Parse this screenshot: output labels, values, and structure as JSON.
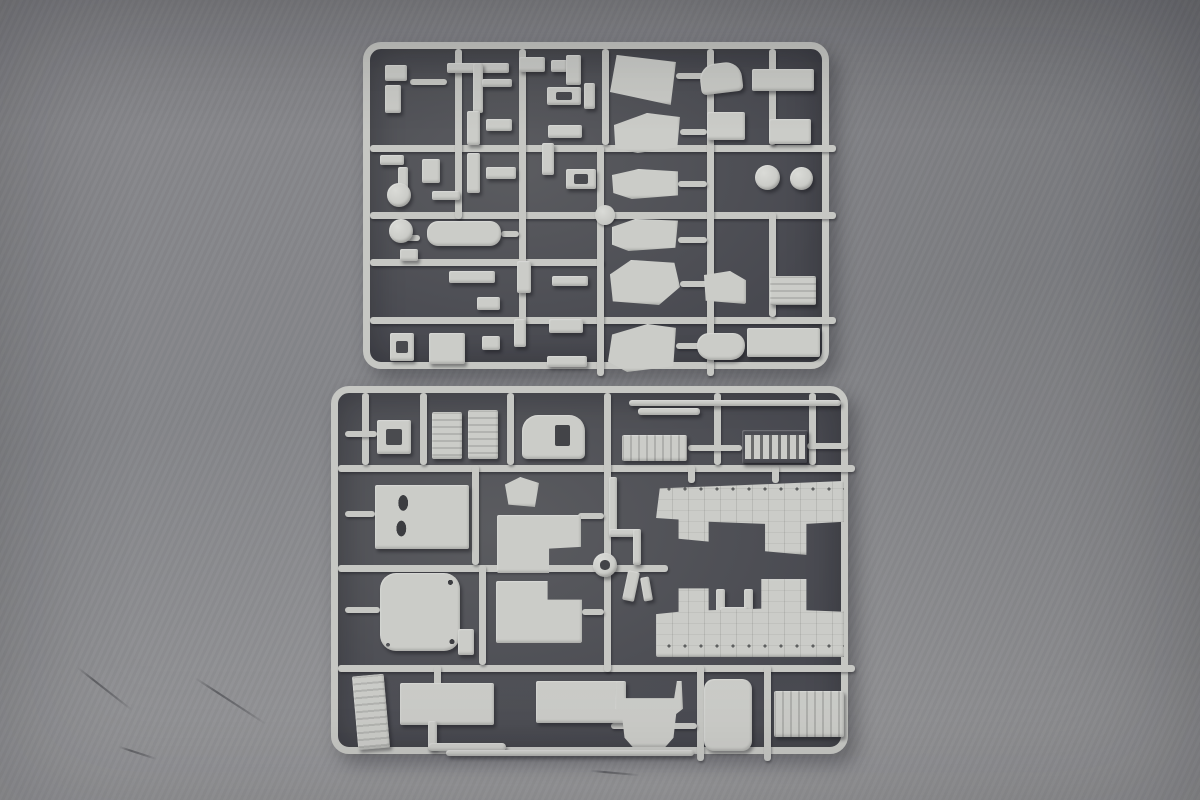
{
  "scene": {
    "colors": {
      "bg-top": "#88888c",
      "bg-mid": "#85868a",
      "bg-bottom": "#9c9c9e",
      "bed-light": "#5b5c60",
      "bed-dark": "#484950",
      "plastic": "#c6c7c3",
      "plastic-hi": "#dadbd7",
      "plastic-part": "#cbccc8"
    }
  },
  "sprues": [
    {
      "name": "sprue-frame-top",
      "x": 363,
      "y": 42,
      "w": 466,
      "h": 327,
      "runners": [
        {
          "x": 0,
          "y": 96,
          "w": 466,
          "h": 7
        },
        {
          "x": 0,
          "y": 163,
          "w": 466,
          "h": 7
        },
        {
          "x": 0,
          "y": 210,
          "w": 234,
          "h": 7
        },
        {
          "x": 0,
          "y": 268,
          "w": 466,
          "h": 7
        },
        {
          "x": 85,
          "y": 0,
          "w": 7,
          "h": 170
        },
        {
          "x": 149,
          "y": 0,
          "w": 7,
          "h": 275
        },
        {
          "x": 227,
          "y": 96,
          "w": 7,
          "h": 231
        },
        {
          "x": 232,
          "y": 0,
          "w": 7,
          "h": 96
        },
        {
          "x": 337,
          "y": 0,
          "w": 7,
          "h": 327
        },
        {
          "x": 399,
          "y": 0,
          "w": 7,
          "h": 96
        },
        {
          "x": 399,
          "y": 163,
          "w": 7,
          "h": 105
        },
        {
          "x": 40,
          "y": 30,
          "w": 37,
          "h": 6
        },
        {
          "x": 306,
          "y": 24,
          "w": 31,
          "h": 6
        },
        {
          "x": 310,
          "y": 80,
          "w": 27,
          "h": 6
        },
        {
          "x": 308,
          "y": 132,
          "w": 29,
          "h": 6
        },
        {
          "x": 308,
          "y": 188,
          "w": 29,
          "h": 6
        },
        {
          "x": 310,
          "y": 232,
          "w": 27,
          "h": 6
        },
        {
          "x": 306,
          "y": 294,
          "w": 31,
          "h": 6
        },
        {
          "x": 36,
          "y": 186,
          "w": 14,
          "h": 6
        },
        {
          "x": 131,
          "y": 182,
          "w": 18,
          "h": 6
        },
        {
          "x": 225,
          "y": 156,
          "w": 20,
          "h": 20,
          "knob": true
        }
      ],
      "parts": [
        {
          "name": "angle-clip-a",
          "x": 15,
          "y": 16,
          "w": 22,
          "h": 16
        },
        {
          "name": "angle-clip-b",
          "x": 15,
          "y": 36,
          "w": 16,
          "h": 28
        },
        {
          "name": "axle-t-bar",
          "x": 77,
          "y": 14,
          "w": 62,
          "h": 10
        },
        {
          "name": "axle-stem",
          "x": 103,
          "y": 14,
          "w": 10,
          "h": 50
        },
        {
          "name": "cross-bar",
          "x": 112,
          "y": 30,
          "w": 30,
          "h": 8
        },
        {
          "name": "bracket-top",
          "x": 149,
          "y": 8,
          "w": 26,
          "h": 15
        },
        {
          "name": "clip-tiny",
          "x": 181,
          "y": 11,
          "w": 16,
          "h": 12
        },
        {
          "name": "l-bracket",
          "x": 196,
          "y": 6,
          "w": 15,
          "h": 30
        },
        {
          "name": "bench-stand",
          "x": 177,
          "y": 38,
          "w": 34,
          "h": 18,
          "detail": "hole-center"
        },
        {
          "name": "figure-post",
          "x": 214,
          "y": 34,
          "w": 11,
          "h": 26
        },
        {
          "name": "hull-glacis-panel-1",
          "x": 240,
          "y": 6,
          "w": 66,
          "h": 50,
          "clip": "polygon(10% 0, 100% 14%, 92% 100%, 0 74%)"
        },
        {
          "name": "curved-roof-panel",
          "x": 330,
          "y": 14,
          "w": 42,
          "h": 30,
          "r": "16px 16px 5px 5px",
          "rot": -7
        },
        {
          "name": "top-plate",
          "x": 382,
          "y": 20,
          "w": 62,
          "h": 22
        },
        {
          "name": "tiny-t-part-a",
          "x": 10,
          "y": 106,
          "w": 24,
          "h": 10
        },
        {
          "name": "tiny-t-part-b",
          "x": 28,
          "y": 118,
          "w": 10,
          "h": 28
        },
        {
          "name": "tiny-angle-part",
          "x": 52,
          "y": 110,
          "w": 18,
          "h": 24
        },
        {
          "name": "tiny-bar-part",
          "x": 62,
          "y": 142,
          "w": 28,
          "h": 9
        },
        {
          "name": "channel-rail-a",
          "x": 97,
          "y": 62,
          "w": 13,
          "h": 34
        },
        {
          "name": "channel-rail-b",
          "x": 97,
          "y": 104,
          "w": 13,
          "h": 40
        },
        {
          "name": "step-bar-a",
          "x": 116,
          "y": 70,
          "w": 26,
          "h": 12
        },
        {
          "name": "step-bar-b",
          "x": 116,
          "y": 118,
          "w": 30,
          "h": 12
        },
        {
          "name": "bench-frame",
          "x": 178,
          "y": 76,
          "w": 34,
          "h": 13
        },
        {
          "name": "post-pair",
          "x": 172,
          "y": 94,
          "w": 12,
          "h": 32
        },
        {
          "name": "h-table-bracket",
          "x": 196,
          "y": 120,
          "w": 30,
          "h": 20,
          "detail": "hole-center"
        },
        {
          "name": "hull-glacis-panel-2",
          "x": 244,
          "y": 64,
          "w": 66,
          "h": 40,
          "clip": "polygon(0 30%, 50% 0, 100% 10%, 96% 86%, 36% 100%, 2% 88%)"
        },
        {
          "name": "box-part-a",
          "x": 337,
          "y": 63,
          "w": 38,
          "h": 28
        },
        {
          "name": "box-part-b",
          "x": 399,
          "y": 70,
          "w": 42,
          "h": 25
        },
        {
          "name": "wheel-dome-a",
          "shape": "circle",
          "x": 385,
          "y": 116,
          "w": 25,
          "h": 25
        },
        {
          "name": "wheel-dome-b",
          "shape": "circle",
          "x": 420,
          "y": 118,
          "w": 23,
          "h": 23
        },
        {
          "name": "road-wheel-a",
          "shape": "circle",
          "x": 17,
          "y": 134,
          "w": 24,
          "h": 24
        },
        {
          "name": "road-wheel-b",
          "shape": "circle",
          "x": 19,
          "y": 170,
          "w": 24,
          "h": 24
        },
        {
          "name": "hull-tub-part",
          "x": 57,
          "y": 172,
          "w": 74,
          "h": 25,
          "r": 11
        },
        {
          "name": "mini-mount",
          "x": 30,
          "y": 200,
          "w": 18,
          "h": 12
        },
        {
          "name": "hook-rod",
          "x": 147,
          "y": 212,
          "w": 14,
          "h": 32
        },
        {
          "name": "knob-bar",
          "x": 79,
          "y": 222,
          "w": 46,
          "h": 12
        },
        {
          "name": "elbow-clip",
          "x": 107,
          "y": 248,
          "w": 23,
          "h": 13
        },
        {
          "name": "rod-flat",
          "x": 182,
          "y": 227,
          "w": 36,
          "h": 10
        },
        {
          "name": "hull-step-panel-3",
          "x": 242,
          "y": 120,
          "w": 66,
          "h": 30,
          "clip": "polygon(0 20%, 40% 0, 100% 8%, 100% 88%, 30% 100%, 2% 80%)"
        },
        {
          "name": "hull-step-panel-4",
          "x": 242,
          "y": 170,
          "w": 66,
          "h": 32,
          "clip": "polygon(0 25%, 35% 0, 100% 5%, 96% 90%, 25% 100%, 0 80%)"
        },
        {
          "name": "hull-glacis-panel-5",
          "x": 240,
          "y": 211,
          "w": 70,
          "h": 45,
          "clip": "polygon(0 32%, 30% 0, 92% 6%, 100% 60%, 70% 100%, 4% 92%)"
        },
        {
          "name": "hull-glacis-panel-6",
          "x": 238,
          "y": 275,
          "w": 68,
          "h": 48,
          "clip": "polygon(6% 22%, 58% 0, 100% 8%, 96% 88%, 28% 100%, 0 78%)"
        },
        {
          "name": "angled-block",
          "x": 334,
          "y": 222,
          "w": 42,
          "h": 33,
          "clip": "polygon(0 12%, 62% 0, 100% 28%, 100% 100%, 4% 90%)"
        },
        {
          "name": "ribbed-plate",
          "x": 400,
          "y": 227,
          "w": 46,
          "h": 29,
          "detail": "stripes-h"
        },
        {
          "name": "corner-bracket",
          "x": 20,
          "y": 284,
          "w": 24,
          "h": 28,
          "detail": "hole-center"
        },
        {
          "name": "notched-block",
          "x": 59,
          "y": 284,
          "w": 36,
          "h": 31
        },
        {
          "name": "clip-small",
          "x": 112,
          "y": 287,
          "w": 18,
          "h": 14
        },
        {
          "name": "pin-part-a",
          "x": 144,
          "y": 270,
          "w": 12,
          "h": 28
        },
        {
          "name": "pin-part-b",
          "x": 179,
          "y": 270,
          "w": 34,
          "h": 14
        },
        {
          "name": "rail-bar",
          "x": 177,
          "y": 307,
          "w": 40,
          "h": 11
        },
        {
          "name": "tub-round-part",
          "x": 327,
          "y": 284,
          "w": 48,
          "h": 27,
          "r": "12px 12px 14px 14px"
        },
        {
          "name": "plate-long",
          "x": 377,
          "y": 279,
          "w": 73,
          "h": 29
        }
      ]
    },
    {
      "name": "sprue-frame-bottom",
      "x": 331,
      "y": 386,
      "w": 517,
      "h": 368,
      "runners": [
        {
          "x": 0,
          "y": 72,
          "w": 517,
          "h": 7
        },
        {
          "x": 0,
          "y": 172,
          "w": 330,
          "h": 7
        },
        {
          "x": 0,
          "y": 272,
          "w": 517,
          "h": 7
        },
        {
          "x": 24,
          "y": 0,
          "w": 7,
          "h": 72
        },
        {
          "x": 82,
          "y": 0,
          "w": 7,
          "h": 72
        },
        {
          "x": 169,
          "y": 0,
          "w": 7,
          "h": 72
        },
        {
          "x": 266,
          "y": 0,
          "w": 7,
          "h": 279
        },
        {
          "x": 376,
          "y": 0,
          "w": 7,
          "h": 72
        },
        {
          "x": 471,
          "y": 0,
          "w": 7,
          "h": 72
        },
        {
          "x": 134,
          "y": 72,
          "w": 7,
          "h": 100
        },
        {
          "x": 141,
          "y": 172,
          "w": 7,
          "h": 100
        },
        {
          "x": 359,
          "y": 272,
          "w": 7,
          "h": 96
        },
        {
          "x": 426,
          "y": 272,
          "w": 7,
          "h": 96
        },
        {
          "x": 7,
          "y": 38,
          "w": 32,
          "h": 6
        },
        {
          "x": 210,
          "y": 42,
          "w": 20,
          "h": 6
        },
        {
          "x": 350,
          "y": 52,
          "w": 54,
          "h": 6
        },
        {
          "x": 469,
          "y": 50,
          "w": 41,
          "h": 6
        },
        {
          "x": 7,
          "y": 118,
          "w": 30,
          "h": 6
        },
        {
          "x": 7,
          "y": 214,
          "w": 35,
          "h": 6
        },
        {
          "x": 240,
          "y": 120,
          "w": 26,
          "h": 6
        },
        {
          "x": 244,
          "y": 216,
          "w": 22,
          "h": 6
        },
        {
          "x": 350,
          "y": 72,
          "w": 7,
          "h": 18
        },
        {
          "x": 434,
          "y": 72,
          "w": 7,
          "h": 18
        },
        {
          "x": 273,
          "y": 330,
          "w": 86,
          "h": 6
        },
        {
          "x": 96,
          "y": 272,
          "w": 7,
          "h": 24
        }
      ],
      "parts": [
        {
          "name": "ring-frame-part",
          "x": 39,
          "y": 27,
          "w": 34,
          "h": 34,
          "detail": "hole-center"
        },
        {
          "name": "striped-panel-a",
          "x": 94,
          "y": 19,
          "w": 30,
          "h": 47,
          "detail": "stripes-h"
        },
        {
          "name": "striped-panel-b",
          "x": 130,
          "y": 17,
          "w": 30,
          "h": 49,
          "detail": "stripes-h"
        },
        {
          "name": "arch-hatch-panel",
          "x": 184,
          "y": 22,
          "w": 63,
          "h": 44,
          "r": "16px 16px 5px 5px",
          "detail": "hole-square"
        },
        {
          "name": "barrel-rod",
          "x": 291,
          "y": 7,
          "w": 212,
          "h": 6,
          "r": 3
        },
        {
          "name": "rod-fitting",
          "x": 300,
          "y": 15,
          "w": 62,
          "h": 7,
          "r": 3
        },
        {
          "name": "radiator-panel-small",
          "x": 284,
          "y": 42,
          "w": 65,
          "h": 26,
          "detail": "stripes-v"
        },
        {
          "name": "track-grille-part",
          "x": 404,
          "y": 37,
          "w": 66,
          "h": 34,
          "detail": "grille"
        },
        {
          "name": "panel-with-two-holes",
          "x": 37,
          "y": 92,
          "w": 94,
          "h": 64,
          "detail": "holes2"
        },
        {
          "name": "winch-block",
          "x": 167,
          "y": 84,
          "w": 34,
          "h": 30,
          "clip": "polygon(0 25%, 45% 0, 100% 20%, 88% 100%, 10% 92%)"
        },
        {
          "name": "step-panel-a",
          "x": 159,
          "y": 122,
          "w": 84,
          "h": 58,
          "clip": "polygon(0 0, 100% 0, 100% 55%, 62% 58%, 62% 100%, 0 100%)"
        },
        {
          "name": "pipe-s-vertical",
          "x": 271,
          "y": 84,
          "w": 8,
          "h": 58
        },
        {
          "name": "pipe-s-horizontal",
          "x": 271,
          "y": 136,
          "w": 30,
          "h": 8
        },
        {
          "name": "pipe-s-vertical-2",
          "x": 295,
          "y": 136,
          "w": 8,
          "h": 36
        },
        {
          "name": "hull-side-upper",
          "x": 318,
          "y": 88,
          "w": 188,
          "h": 74,
          "detail": "rivets-top",
          "clip": "polygon(0 50%, 2% 10%, 100% 0, 100% 55%, 80% 58%, 80% 100%, 58% 95%, 58% 58%, 28% 55%, 28% 82%, 12% 78%, 12% 52%)"
        },
        {
          "name": "hatch-round-panel",
          "x": 42,
          "y": 180,
          "w": 80,
          "h": 78,
          "r": 16,
          "detail": "dots-corners"
        },
        {
          "name": "step-panel-b",
          "x": 158,
          "y": 188,
          "w": 86,
          "h": 62,
          "clip": "polygon(0 0, 60% 0, 60% 30%, 100% 30%, 100% 100%, 0 100%)"
        },
        {
          "name": "hook-clip",
          "x": 120,
          "y": 236,
          "w": 16,
          "h": 26
        },
        {
          "name": "sprue-gate-hub",
          "shape": "circle",
          "x": 255,
          "y": 160,
          "w": 24,
          "h": 24,
          "detail": "hole-center-round"
        },
        {
          "name": "clip-part-a",
          "x": 287,
          "y": 178,
          "w": 12,
          "h": 30,
          "rot": 12
        },
        {
          "name": "clip-part-b",
          "x": 304,
          "y": 184,
          "w": 9,
          "h": 24,
          "rot": -10
        },
        {
          "name": "h-bracket-left",
          "x": 378,
          "y": 196,
          "w": 9,
          "h": 46
        },
        {
          "name": "h-bracket-right",
          "x": 406,
          "y": 196,
          "w": 9,
          "h": 46
        },
        {
          "name": "h-bracket-bar",
          "x": 382,
          "y": 214,
          "w": 28,
          "h": 9
        },
        {
          "name": "hull-side-lower",
          "x": 318,
          "y": 186,
          "w": 188,
          "h": 78,
          "detail": "rivets-bottom",
          "clip": "polygon(0 45%, 12% 42%, 12% 12%, 28% 12%, 28% 40%, 56% 38%, 56% 0, 80% 0, 80% 40%, 100% 42%, 100% 100%, 0 100%)"
        },
        {
          "name": "side-skirt-panel",
          "x": 17,
          "y": 282,
          "w": 32,
          "h": 74,
          "rot": -5,
          "detail": "stripes-h"
        },
        {
          "name": "floor-panel-a",
          "x": 62,
          "y": 290,
          "w": 94,
          "h": 42
        },
        {
          "name": "pipe-elbow-vertical",
          "x": 90,
          "y": 328,
          "w": 9,
          "h": 28
        },
        {
          "name": "pipe-elbow-horizontal",
          "x": 90,
          "y": 350,
          "w": 78,
          "h": 8,
          "r": 4
        },
        {
          "name": "floor-panel-b",
          "x": 198,
          "y": 288,
          "w": 90,
          "h": 42
        },
        {
          "name": "long-rod",
          "x": 108,
          "y": 357,
          "w": 248,
          "h": 6,
          "r": 3
        },
        {
          "name": "bumper-trough",
          "x": 277,
          "y": 288,
          "w": 68,
          "h": 66,
          "clip": "polygon(2% 0, 9% 0, 13% 26%, 87% 26%, 91% 0, 98% 0, 100% 42%, 90% 50%, 86% 86%, 74% 100%, 26% 100%, 14% 86%, 10% 50%, 0 42%)"
        },
        {
          "name": "door-panel",
          "x": 366,
          "y": 286,
          "w": 48,
          "h": 72,
          "r": 10
        },
        {
          "name": "radiator-panel-large",
          "x": 436,
          "y": 298,
          "w": 70,
          "h": 46,
          "detail": "stripes-v"
        }
      ]
    }
  ],
  "scratches": [
    {
      "x": 70,
      "y": 688,
      "w": 70,
      "rot": 38
    },
    {
      "x": 188,
      "y": 700,
      "w": 85,
      "rot": 33
    },
    {
      "x": 118,
      "y": 752,
      "w": 40,
      "rot": 18
    },
    {
      "x": 590,
      "y": 772,
      "w": 50,
      "rot": 5
    }
  ]
}
